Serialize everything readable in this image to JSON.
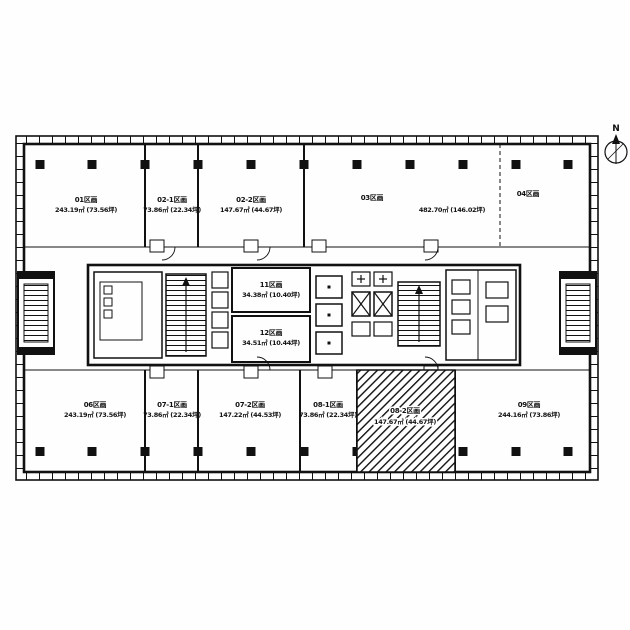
{
  "compass": {
    "label": "N"
  },
  "rooms": {
    "r01": {
      "name": "01区画",
      "area": "243.19㎡ (73.56坪)"
    },
    "r02_1": {
      "name": "02-1区画",
      "area": "73.86㎡ (22.34坪)"
    },
    "r02_2": {
      "name": "02-2区画",
      "area": "147.67㎡ (44.67坪)"
    },
    "r03": {
      "name": "03区画",
      "area": "482.70㎡ (146.02坪)"
    },
    "r04": {
      "name": "04区画"
    },
    "r06": {
      "name": "06区画",
      "area": "243.19㎡ (73.56坪)"
    },
    "r07_1": {
      "name": "07-1区画",
      "area": "73.86㎡ (22.34坪)"
    },
    "r07_2": {
      "name": "07-2区画",
      "area": "147.22㎡ (44.53坪)"
    },
    "r08_1": {
      "name": "08-1区画",
      "area": "73.86㎡ (22.34坪)"
    },
    "r08_2": {
      "name": "08-2区画",
      "area": "147.67㎡ (44.67坪)"
    },
    "r09": {
      "name": "09区画",
      "area": "244.16㎡ (73.86坪)"
    },
    "r11": {
      "name": "11区画",
      "area": "34.38㎡ (10.40坪)"
    },
    "r12": {
      "name": "12区画",
      "area": "34.51㎡ (10.44坪)"
    }
  },
  "colors": {
    "ink": "#111111",
    "paper": "#fefefe"
  }
}
